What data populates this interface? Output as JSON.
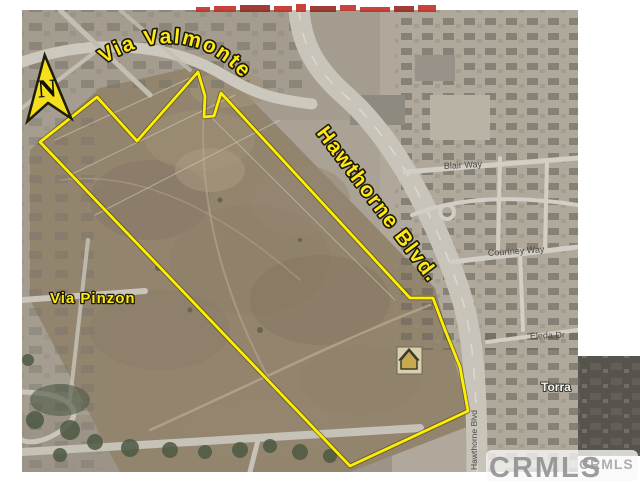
{
  "north_arrow": {
    "label": "N"
  },
  "overlay_street_labels": {
    "via_valmonte": "Via Valmonte",
    "hawthorne_blvd": "Hawthorne Blvd.",
    "via_pinzon": "Via Pinzon"
  },
  "base_street_labels": {
    "blair_way": "Blair Way",
    "courtney_way": "Courtney Way",
    "eleda_dr": "Eleda Dr",
    "torrance_partial": "Torra",
    "hawthorne_blvd_vertical": "Hawthorne Blvd"
  },
  "watermark": {
    "large": "CRMLS",
    "small": "CRMLS"
  },
  "colors": {
    "parcel_boundary_yellow": "#ffee00",
    "overlay_label_yellow": "#ffe81a",
    "north_arrow_yellow": "#f6df1c",
    "red_banner": "#c03028",
    "watermark_gray": "#8c8c8c"
  }
}
